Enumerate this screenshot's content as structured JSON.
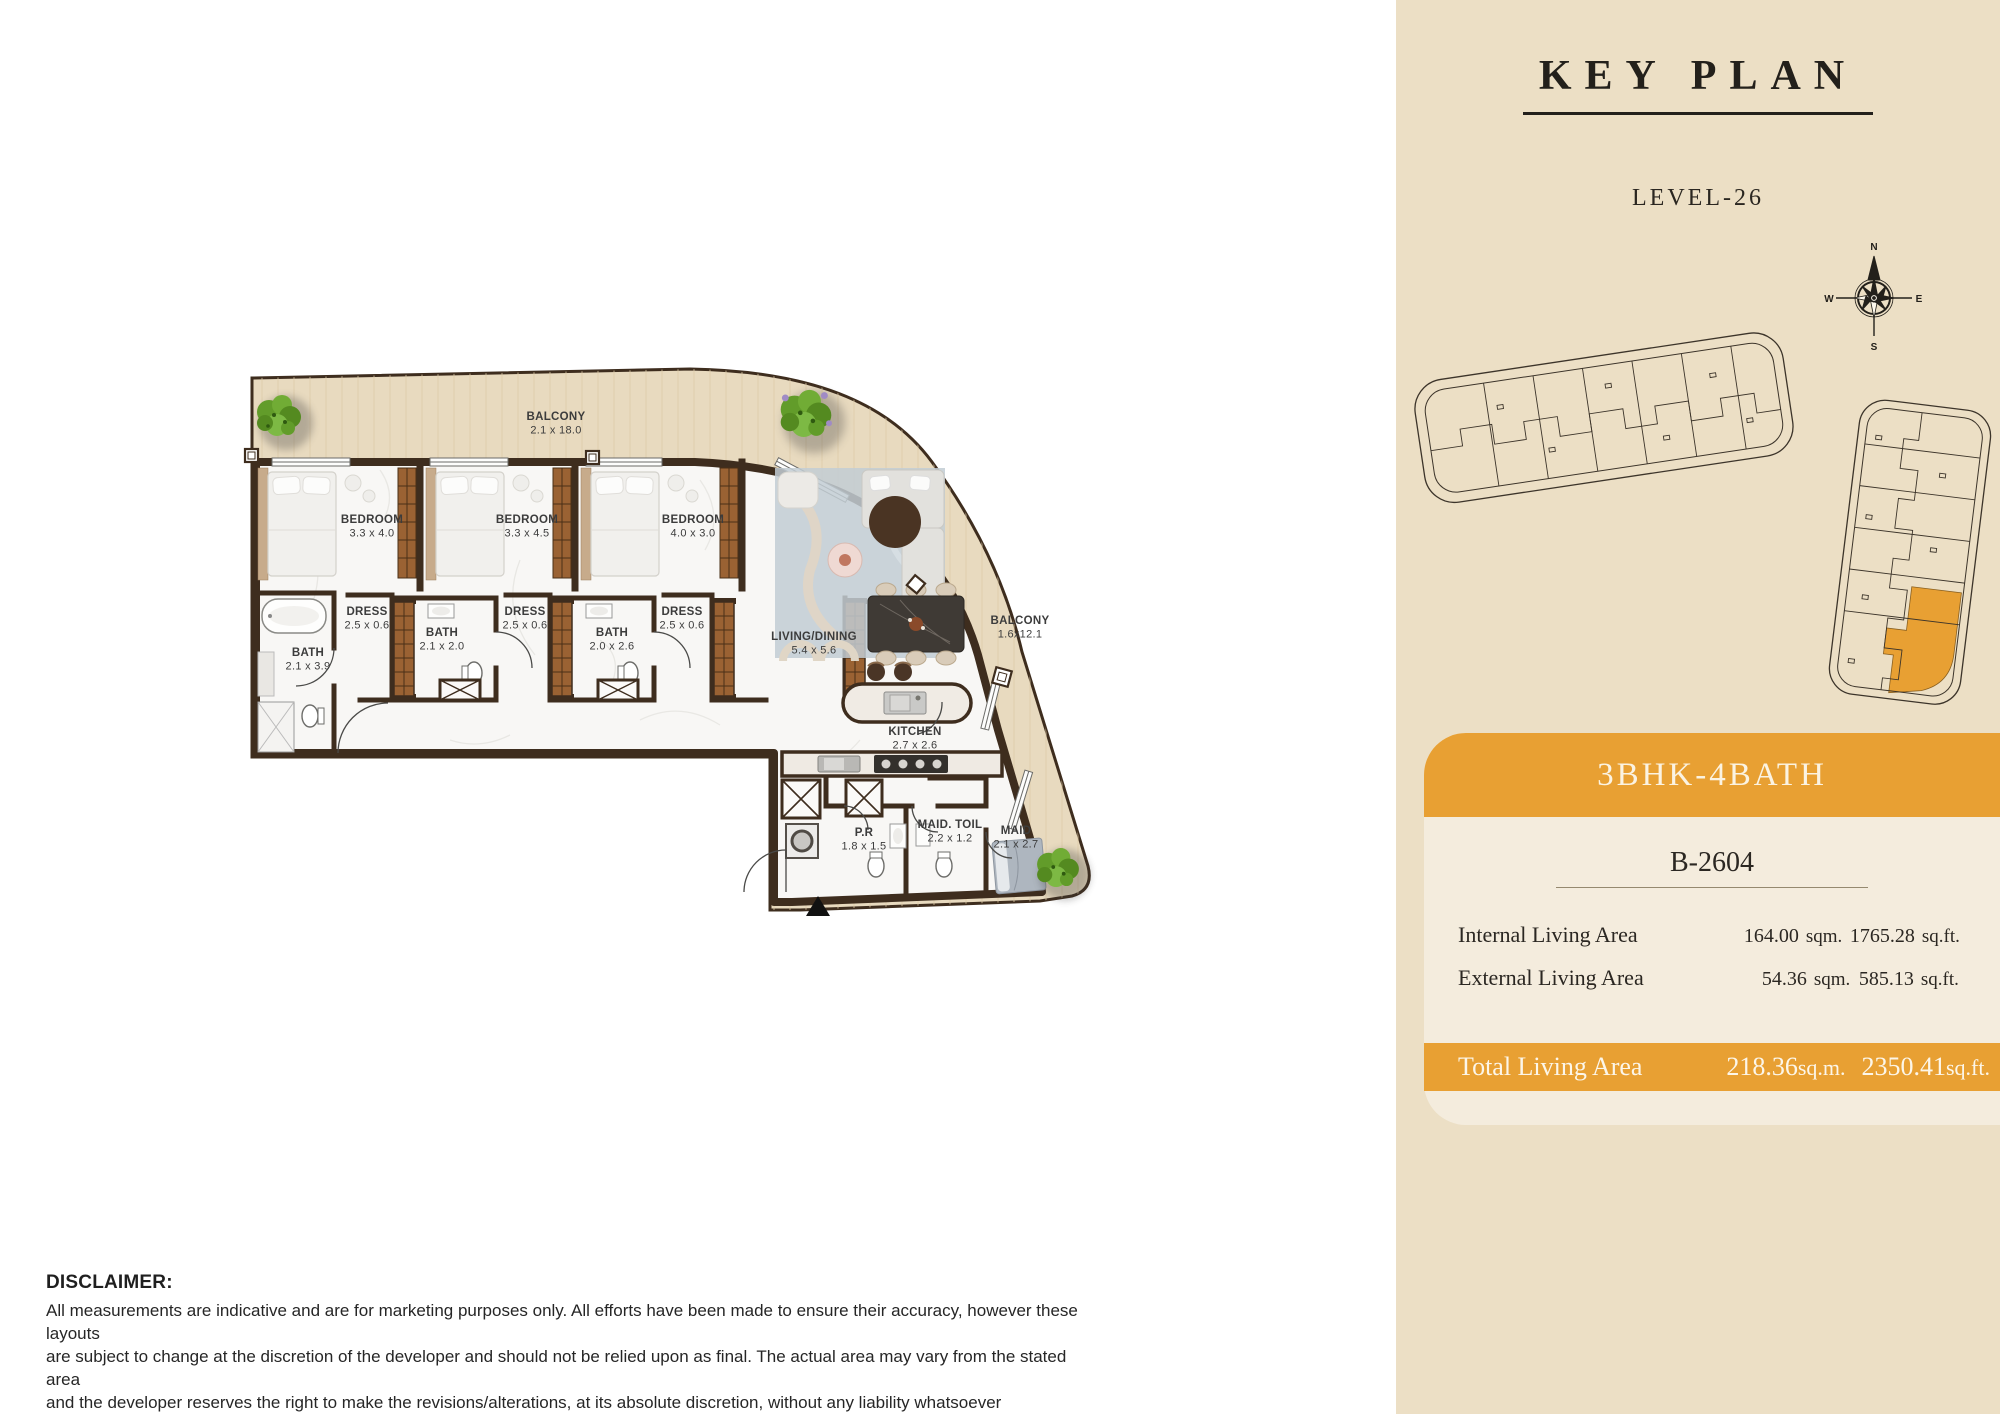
{
  "colors": {
    "accent_orange": "#E8A033",
    "sidebar_bg": "#ECDFC5",
    "wall_brown": "#3E2D1E",
    "wood": "#E8DABF",
    "marble": "#F8F7F5"
  },
  "floor_plan": {
    "rooms": [
      {
        "id": "balcony-top",
        "name": "BALCONY",
        "dims": "2.1 x 18.0",
        "x": 556,
        "y": 420
      },
      {
        "id": "bedroom-1",
        "name": "BEDROOM",
        "dims": "3.3 x 4.0",
        "x": 372,
        "y": 523
      },
      {
        "id": "bedroom-2",
        "name": "BEDROOM",
        "dims": "3.3 x 4.5",
        "x": 527,
        "y": 523
      },
      {
        "id": "bedroom-3",
        "name": "BEDROOM",
        "dims": "4.0 x 3.0",
        "x": 693,
        "y": 523
      },
      {
        "id": "dress-1",
        "name": "DRESS",
        "dims": "2.5 x 0.6",
        "x": 367,
        "y": 615
      },
      {
        "id": "bath-1",
        "name": "BATH",
        "dims": "2.1 x 3.9",
        "x": 308,
        "y": 656
      },
      {
        "id": "bath-2",
        "name": "BATH",
        "dims": "2.1 x 2.0",
        "x": 442,
        "y": 636
      },
      {
        "id": "dress-2",
        "name": "DRESS",
        "dims": "2.5 x 0.6",
        "x": 525,
        "y": 615
      },
      {
        "id": "bath-3",
        "name": "BATH",
        "dims": "2.0 x 2.6",
        "x": 612,
        "y": 636
      },
      {
        "id": "dress-3",
        "name": "DRESS",
        "dims": "2.5 x 0.6",
        "x": 682,
        "y": 615
      },
      {
        "id": "living-dining",
        "name": "LIVING/DINING",
        "dims": "5.4 x 5.6",
        "x": 814,
        "y": 640
      },
      {
        "id": "balcony-right",
        "name": "BALCONY",
        "dims": "1.6x12.1",
        "x": 1020,
        "y": 624
      },
      {
        "id": "kitchen",
        "name": "KITCHEN",
        "dims": "2.7 x 2.6",
        "x": 915,
        "y": 735
      },
      {
        "id": "pr",
        "name": "P.R",
        "dims": "1.8 x 1.5",
        "x": 864,
        "y": 836
      },
      {
        "id": "maid-toil",
        "name": "MAID. TOIL",
        "dims": "2.2 x 1.2",
        "x": 950,
        "y": 828
      },
      {
        "id": "maid",
        "name": "MAID",
        "dims": "2.1 x 2.7",
        "x": 1016,
        "y": 834
      }
    ]
  },
  "key_plan": {
    "title": "KEY PLAN",
    "level": "LEVEL-26",
    "compass": {
      "n": "N",
      "e": "E",
      "s": "S",
      "w": "W"
    }
  },
  "unit_card": {
    "type_label": "3BHK-4BATH",
    "unit_number": "B-2604",
    "rows": [
      {
        "label": "Internal Living Area",
        "sqm": "164.00",
        "sqm_unit": "sqm.",
        "sqft": "1765.28",
        "sqft_unit": "sq.ft."
      },
      {
        "label": "External Living Area",
        "sqm": "54.36",
        "sqm_unit": "sqm.",
        "sqft": "585.13",
        "sqft_unit": "sq.ft."
      }
    ],
    "total": {
      "label": "Total Living Area",
      "sqm": "218.36",
      "sqm_unit": "sq.m.",
      "sqft": "2350.41",
      "sqft_unit": "sq.ft."
    }
  },
  "disclaimer": {
    "title": "DISCLAIMER:",
    "lines": [
      "All measurements are indicative and are for marketing purposes only. All efforts have been made to ensure their accuracy, however these layouts",
      "are subject to change at the discretion of the developer and should not be relied upon as final. The actual area may vary from the stated area",
      "and the developer reserves the right to make the revisions/alterations, at its absolute discretion, without any liability whatsoever"
    ]
  }
}
